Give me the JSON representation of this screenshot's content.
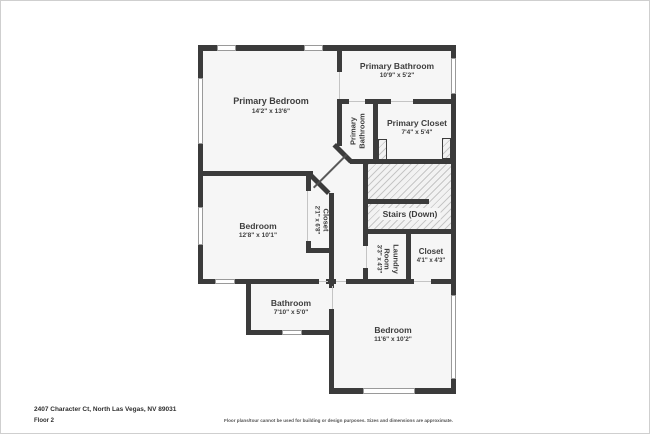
{
  "palette": {
    "wall": "#3b3b3b",
    "room_fill": "#f6f6f6",
    "hatch_line": "#c6c6c6",
    "window_border": "#9a9a9a",
    "label_text": "#3d3d3d"
  },
  "rooms": {
    "primary_bedroom": {
      "name": "Primary Bedroom",
      "dims": "14'2\" x 13'6\""
    },
    "primary_bathroom": {
      "name": "Primary Bathroom",
      "dims": "10'9\" x 5'2\""
    },
    "primary_bathroom_wc": {
      "name": "Primary Bathroom"
    },
    "primary_closet": {
      "name": "Primary Closet",
      "dims": "7'4\" x 5'4\""
    },
    "stairs": {
      "name": "Stairs (Down)"
    },
    "bedroom_left": {
      "name": "Bedroom",
      "dims": "12'8\" x 10'1\""
    },
    "bedroom_closet": {
      "name": "Closet",
      "dims": "2'1\" x 6'8\""
    },
    "laundry": {
      "name": "Laundry Room",
      "dims": "3'3\" x 4'3\""
    },
    "closet": {
      "name": "Closet",
      "dims": "4'1\" x 4'3\""
    },
    "bathroom": {
      "name": "Bathroom",
      "dims": "7'10\" x 5'0\""
    },
    "bedroom_bottom": {
      "name": "Bedroom",
      "dims": "11'6\" x 10'2\""
    }
  },
  "footer": {
    "address": "2407 Character Ct, North Las Vegas, NV 89031",
    "floor": "Floor 2",
    "disclaimer": "Floor plans/tour cannot be used for building or design purposes. Sizes and dimensions are approximate."
  }
}
